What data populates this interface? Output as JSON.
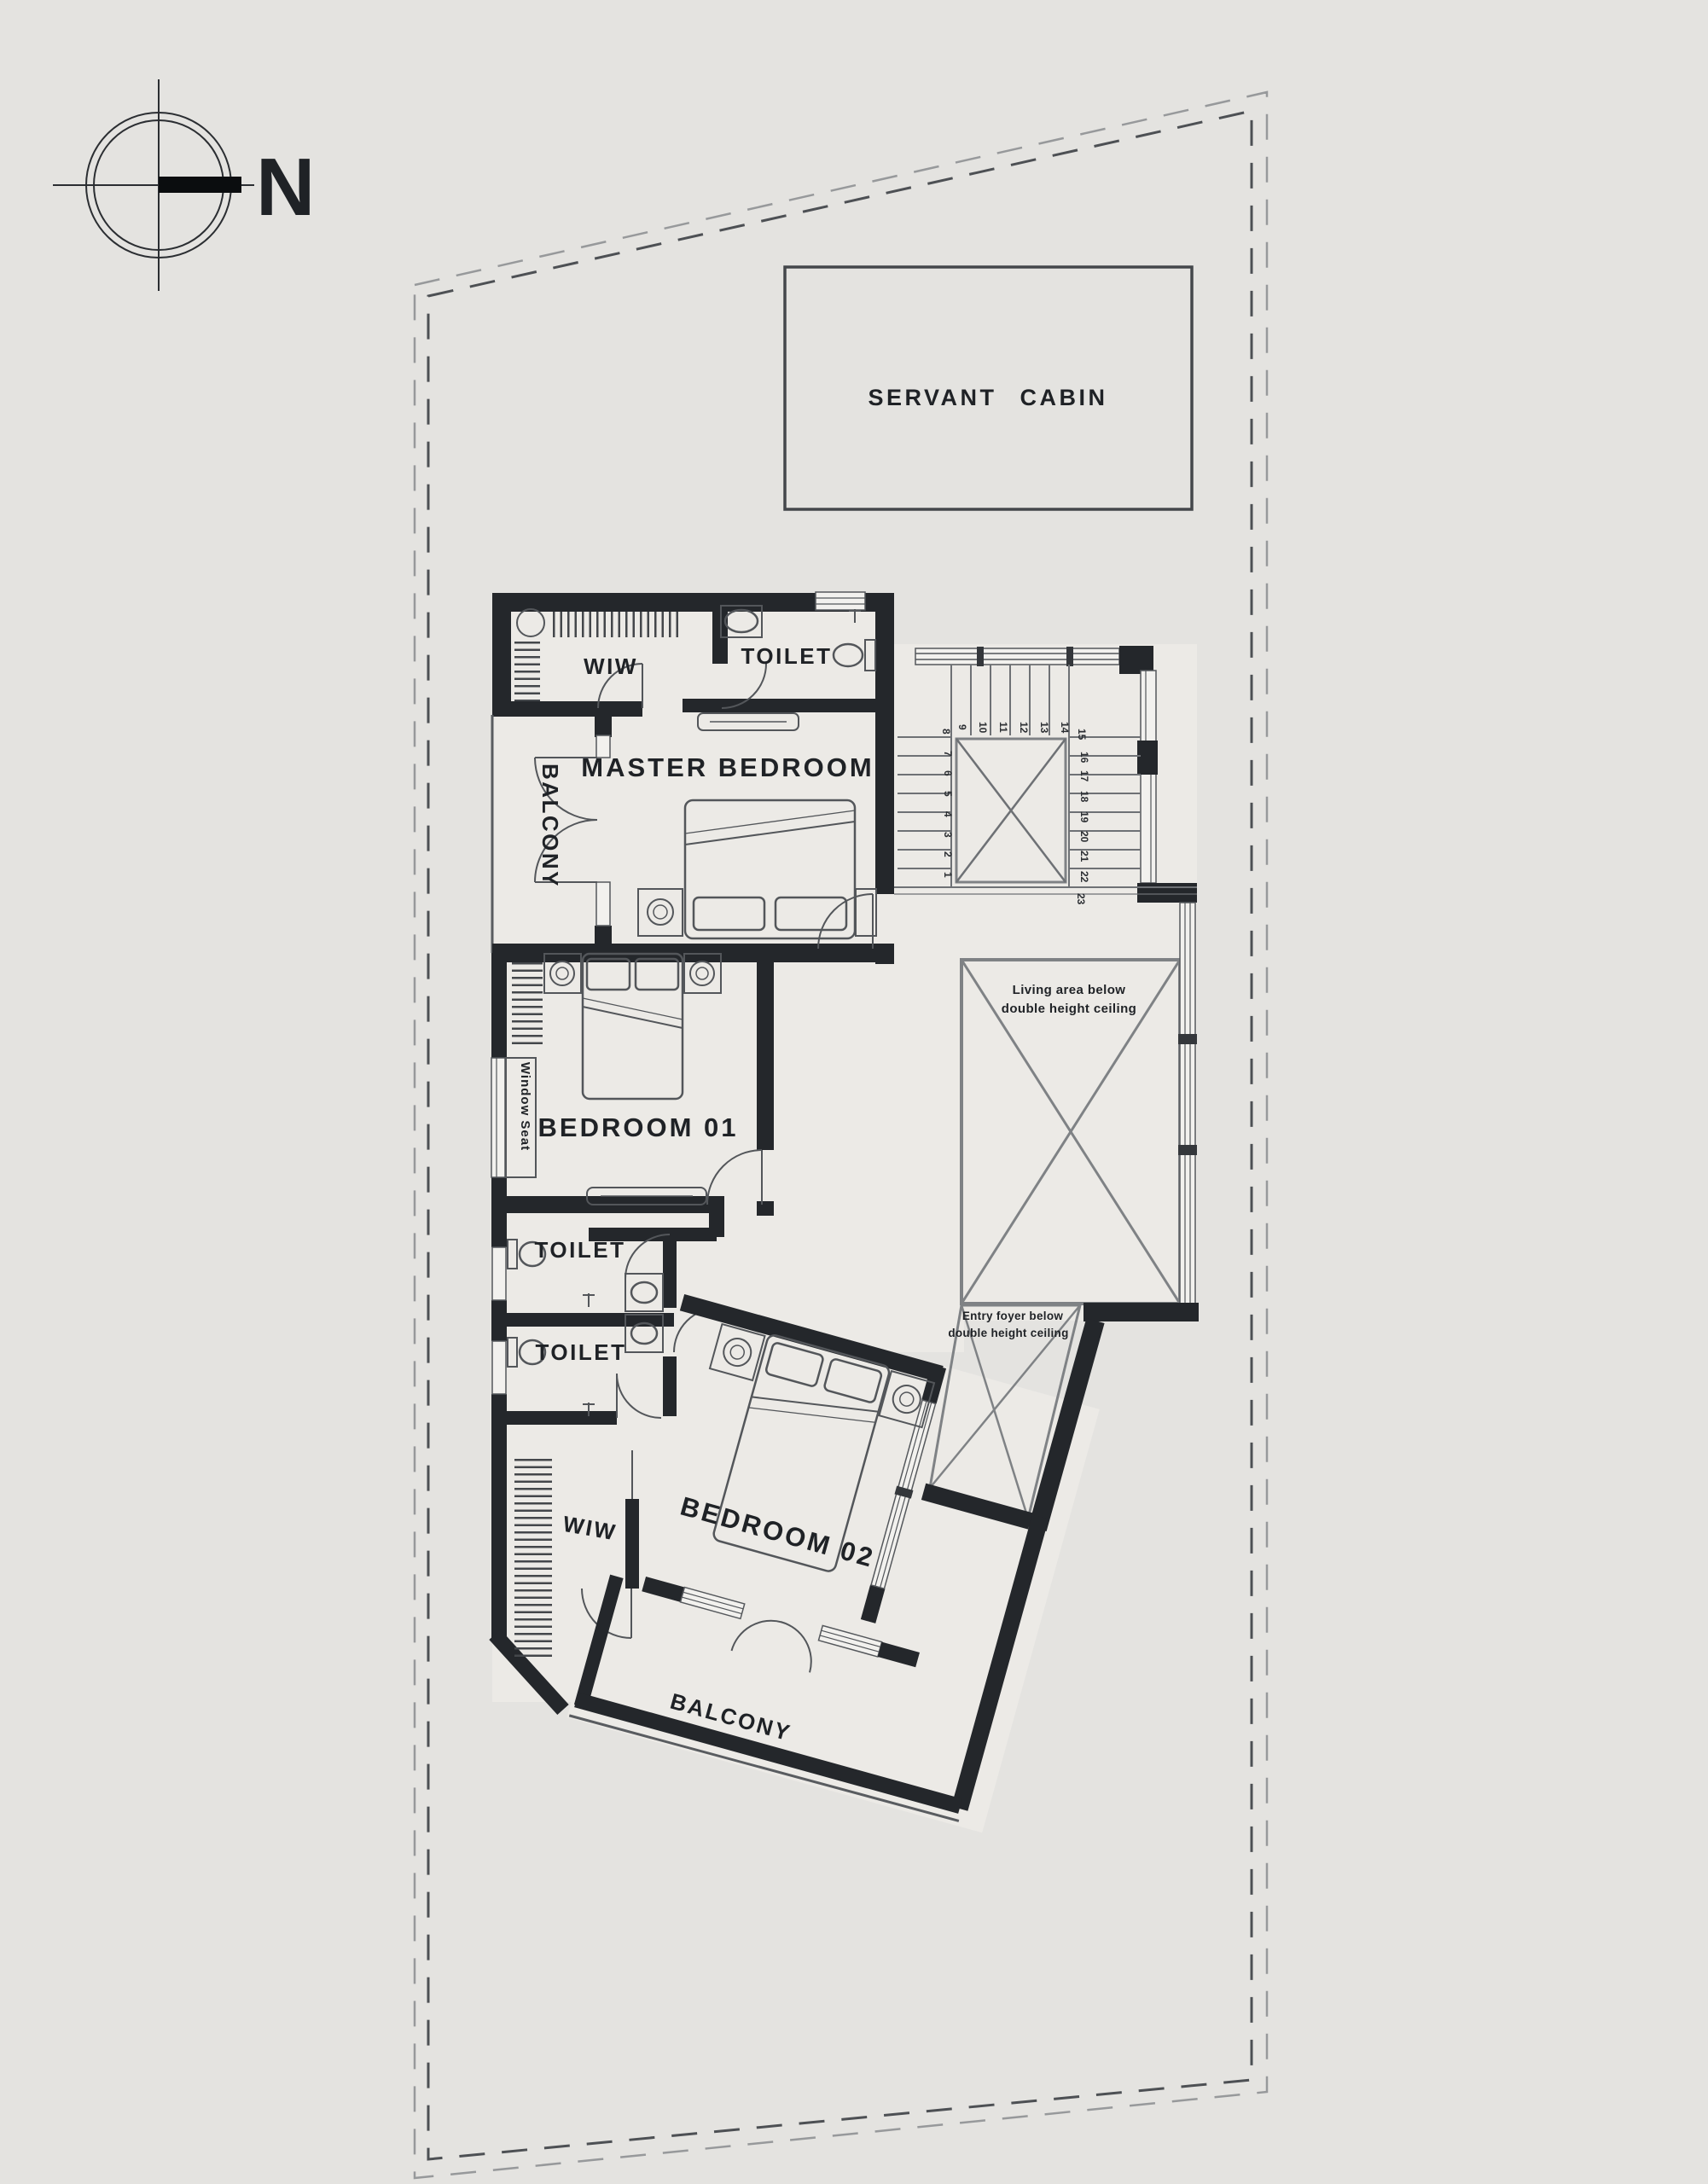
{
  "page": {
    "background": "#e4e3e0",
    "floor_color": "#eceae6",
    "wall_color": "#24272b",
    "line_color": "#6e7175",
    "text_color": "#1f2226"
  },
  "compass": {
    "label": "N"
  },
  "servant_cabin": {
    "label": "SERVANT CABIN"
  },
  "master_suite": {
    "wiw": "WIW",
    "toilet": "TOILET",
    "name": "MASTER BEDROOM",
    "balcony": "BALCONY"
  },
  "bedroom01": {
    "name": "BEDROOM 01",
    "window_seat": "Window Seat"
  },
  "toilets": {
    "toilet_a": "TOILET",
    "toilet_b": "TOILET"
  },
  "bedroom02": {
    "name": "BEDROOM 02",
    "wiw": "WIW",
    "balcony": "BALCONY"
  },
  "voids": {
    "living": {
      "line1": "Living area below",
      "line2": "double height ceiling"
    },
    "foyer": {
      "line1": "Entry foyer below",
      "line2": "double height ceiling"
    }
  },
  "stairs": {
    "numbers": [
      "1",
      "2",
      "3",
      "4",
      "5",
      "6",
      "7",
      "8",
      "9",
      "10",
      "11",
      "12",
      "13",
      "14",
      "15",
      "16",
      "17",
      "18",
      "19",
      "20",
      "21",
      "22",
      "23"
    ]
  }
}
